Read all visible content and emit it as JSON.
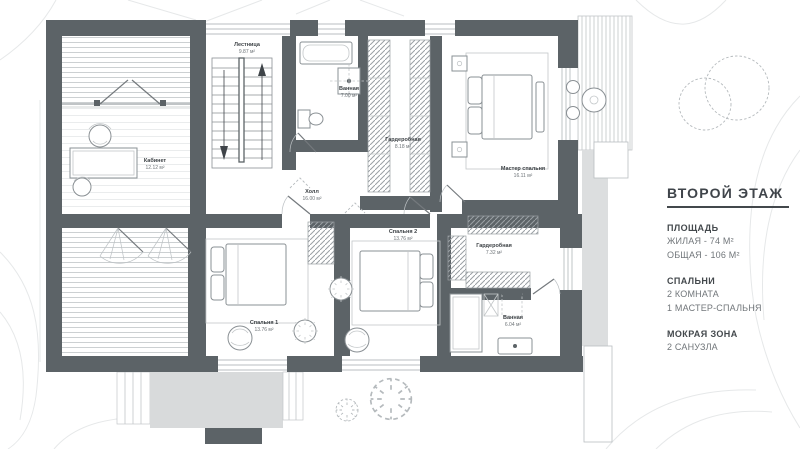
{
  "panel": {
    "title": "ВТОРОЙ ЭТАЖ",
    "sections": [
      {
        "heading": "ПЛОЩАДЬ",
        "lines": [
          "ЖИЛАЯ - 74 М²",
          "ОБЩАЯ - 106 М²"
        ]
      },
      {
        "heading": "СПАЛЬНИ",
        "lines": [
          "2 КОМНАТА",
          "1 МАСТЕР-СПАЛЬНЯ"
        ]
      },
      {
        "heading": "МОКРАЯ ЗОНА",
        "lines": [
          "2 САНУЗЛА"
        ]
      }
    ]
  },
  "rooms": [
    {
      "name": "Лестница",
      "area": "9.87 м²"
    },
    {
      "name": "Ванная",
      "area": "7.00 м²"
    },
    {
      "name": "Гардеробная",
      "area": "8.18 м²"
    },
    {
      "name": "Мастер спальня",
      "area": "16.11 м²"
    },
    {
      "name": "Кабинет",
      "area": "12.12 м²"
    },
    {
      "name": "Холл",
      "area": "16.00 м²"
    },
    {
      "name": "Спальня 2",
      "area": "13.76 м²"
    },
    {
      "name": "Гардеробная",
      "area": "7.32 м²"
    },
    {
      "name": "Спальня 1",
      "area": "13.76 м²"
    },
    {
      "name": "Ванная",
      "area": "6.04 м²"
    }
  ],
  "colors": {
    "wall": "#5c6367",
    "terrace": "#d8dadb",
    "text_dark": "#3c4145",
    "text_gray": "#6e7478"
  }
}
